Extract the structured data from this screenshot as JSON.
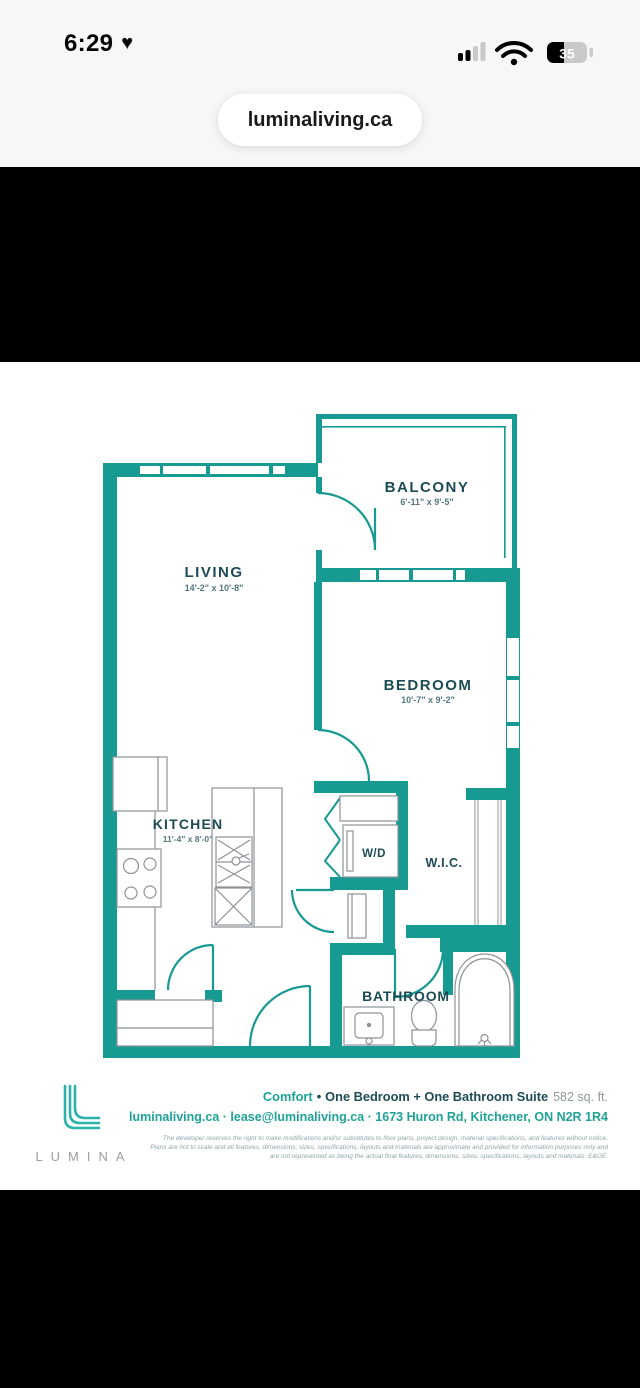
{
  "status_bar": {
    "time": "6:29",
    "heart_glyph": "♥",
    "battery_percent": "35"
  },
  "browser": {
    "url": "luminaliving.ca"
  },
  "floor_plan": {
    "rooms": [
      {
        "label": "LIVING",
        "dims": "14'-2\" x 10'-8\""
      },
      {
        "label": "BALCONY",
        "dims": "6'-11\" x 9'-5\""
      },
      {
        "label": "BEDROOM",
        "dims": "10'-7\" x 9'-2\""
      },
      {
        "label": "KITCHEN",
        "dims": "11'-4\" x 8'-0\""
      },
      {
        "label": "W/D"
      },
      {
        "label": "W.I.C."
      },
      {
        "label": "BATHROOM"
      }
    ],
    "colors": {
      "wall": "#179a92",
      "label": "#1d4b55",
      "accent": "#1fa396"
    }
  },
  "footer": {
    "brand": "LUMINA",
    "plan_name": "Comfort",
    "separator": "•",
    "suite_type": "One Bedroom + One Bathroom Suite",
    "area": "582 sq. ft.",
    "contact": "luminaliving.ca · lease@luminaliving.ca · 1673 Huron Rd, Kitchener, ON N2R 1R4",
    "disclaimer": "The developer reserves the right to make modifications and/or substitutes to floor plans, project design, material specifications, and features without notice.\nPlans are not to scale and all features, dimensions, sizes, specifications, layouts and materials are approximate and provided for information purposes only and\nare not represented as being the actual final features, dimensions, sizes, specifications, layouts and materials. E&OE."
  }
}
